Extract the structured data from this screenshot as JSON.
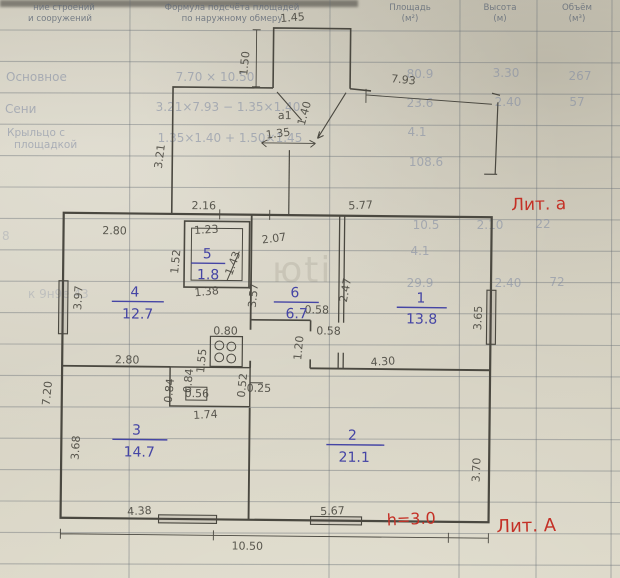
{
  "form": {
    "headers": {
      "objects_l1": "ние строений",
      "objects_l2": "и сооружений",
      "formula_l1": "Формула подсчёта площадей",
      "formula_l2": "по наружному обмеру",
      "area_l1": "Площадь",
      "area_l2": "(м²)",
      "height_l1": "Высота",
      "height_l2": "(м)",
      "volume_l1": "Объём",
      "volume_l2": "(м³)"
    },
    "rows": {
      "r1": {
        "label": "Основное",
        "formula": "7.70 × 10.50",
        "area": "80.9",
        "height": "3.30",
        "volume": "267"
      },
      "r2": {
        "label": "Сени",
        "formula": "3.21×7.93 − 1.35×1.40",
        "area": "23.6",
        "height": "2.40",
        "volume": "57"
      },
      "r3": {
        "label_l1": "Крыльцо с",
        "label_l2": "площадкой",
        "formula": "1.35×1.40 + 1.50×1.45",
        "area": "4.1"
      },
      "r4": {
        "area": "108.6"
      },
      "r5": {
        "area": "10.5",
        "height": "2.10",
        "volume": "22"
      },
      "r6": {
        "area": "4.1"
      },
      "r7": {
        "area": "29.9",
        "height": "2.40",
        "volume": "72"
      }
    },
    "artifacts": {
      "a1": "8",
      "a2": "к 9н9е 43",
      "watermark": "юti"
    }
  },
  "plan": {
    "red": {
      "lit_a": "Лит. а",
      "h": "h=3.0",
      "lit_A": "Лит. А"
    },
    "rooms": {
      "r1": {
        "num": "1",
        "area": "13.8"
      },
      "r2": {
        "num": "2",
        "area": "21.1"
      },
      "r3": {
        "num": "3",
        "area": "14.7"
      },
      "r4": {
        "num": "4",
        "area": "12.7"
      },
      "r5": {
        "num": "5",
        "area": "1.8"
      },
      "r6": {
        "num": "6",
        "area": "6.7"
      }
    },
    "dims": {
      "porch_w": "1.45",
      "porch_h": "1.50",
      "annex_len": "7.93",
      "porch_label": "а1",
      "step_h": "1.40",
      "step_w": "1.35",
      "annex_h": "3.21",
      "top_left": "2.16",
      "top_right": "5.77",
      "w280a": "2.80",
      "w123": "1.23",
      "w207": "2.07",
      "w152": "1.52",
      "w143": "1.43",
      "w397": "3.97",
      "w138": "1.38",
      "w357": "3.57",
      "w058a": "0.58",
      "w247": "2.47",
      "w365": "3.65",
      "w080": "0.80",
      "w058b": "0.58",
      "w120": "1.20",
      "w155": "1.55",
      "w280b": "2.80",
      "w430": "4.30",
      "w084a": "0.84",
      "w084b": "0.84",
      "w056": "0.56",
      "w052": "0.52",
      "w025": "0.25",
      "w174": "1.74",
      "w720": "7.20",
      "w368": "3.68",
      "w370": "3.70",
      "b438": "4.38",
      "b567": "5.67",
      "b1050": "10.50"
    }
  }
}
